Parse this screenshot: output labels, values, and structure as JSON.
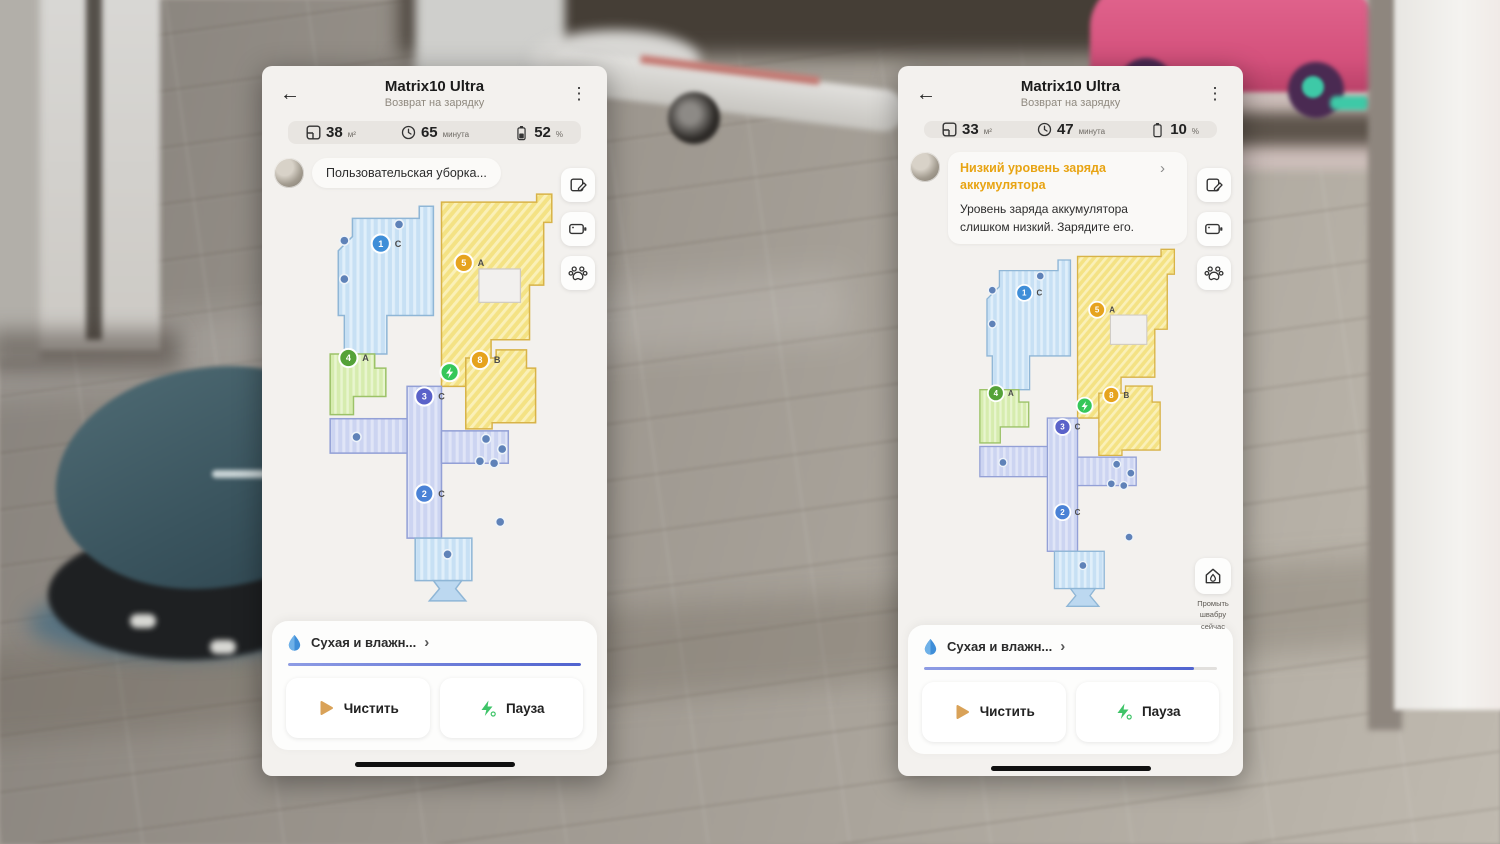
{
  "glyphs": {
    "back": "←",
    "menu": "⋮",
    "chevron": "›"
  },
  "colors": {
    "warning_orange": "#e8a413",
    "progress_blue": "#5063cf",
    "pause_green": "#3ec468",
    "clean_play_tan": "#d9a258",
    "dock_green": "#35c759",
    "room_blue": "#c7e0f4",
    "room_yellow": "#f4e284",
    "room_green": "#d6ecae",
    "corridor_periwinkle": "#ccd4f1"
  },
  "phones": [
    {
      "title": "Matrix10 Ultra",
      "subtitle": "Возврат на зарядку",
      "stats": {
        "area_value": "38",
        "area_unit": "м²",
        "time_value": "65",
        "time_unit": "минута",
        "battery_value": "52",
        "battery_unit": "%"
      },
      "status": {
        "label": "Пользовательская уборка..."
      },
      "mode": {
        "label": "Сухая и влажн...",
        "progress_pct": 100
      },
      "actions": {
        "clean": "Чистить",
        "pause": "Пауза"
      },
      "map": {
        "dock_color": "#35c759",
        "markers": [
          {
            "num": "1",
            "letter": "C",
            "color": "#3f8ed8"
          },
          {
            "num": "5",
            "letter": "A",
            "color": "#e6a31e"
          },
          {
            "num": "4",
            "letter": "A",
            "color": "#55a238"
          },
          {
            "num": "3",
            "letter": "C",
            "color": "#5a62c9"
          },
          {
            "num": "8",
            "letter": "B",
            "color": "#e6a31e"
          },
          {
            "num": "2",
            "letter": "C",
            "color": "#4a82d6"
          }
        ]
      }
    },
    {
      "title": "Matrix10 Ultra",
      "subtitle": "Возврат на зарядку",
      "stats": {
        "area_value": "33",
        "area_unit": "м²",
        "time_value": "47",
        "time_unit": "минута",
        "battery_value": "10",
        "battery_unit": "%"
      },
      "status": {
        "warning_title": "Низкий уровень заряда аккумулятора",
        "warning_body": "Уровень заряда аккумулятора слишком низкий. Зарядите его."
      },
      "mop_button": {
        "label": "Промыть\nшвабру\nсейчас"
      },
      "mode": {
        "label": "Сухая и влажн...",
        "progress_pct": 92
      },
      "actions": {
        "clean": "Чистить",
        "pause": "Пауза"
      },
      "map": {
        "dock_color": "#35c759",
        "markers": [
          {
            "num": "1",
            "letter": "C",
            "color": "#3f8ed8"
          },
          {
            "num": "5",
            "letter": "A",
            "color": "#e6a31e"
          },
          {
            "num": "4",
            "letter": "A",
            "color": "#55a238"
          },
          {
            "num": "3",
            "letter": "C",
            "color": "#5a62c9"
          },
          {
            "num": "8",
            "letter": "B",
            "color": "#e6a31e"
          },
          {
            "num": "2",
            "letter": "C",
            "color": "#4a82d6"
          }
        ]
      }
    }
  ]
}
